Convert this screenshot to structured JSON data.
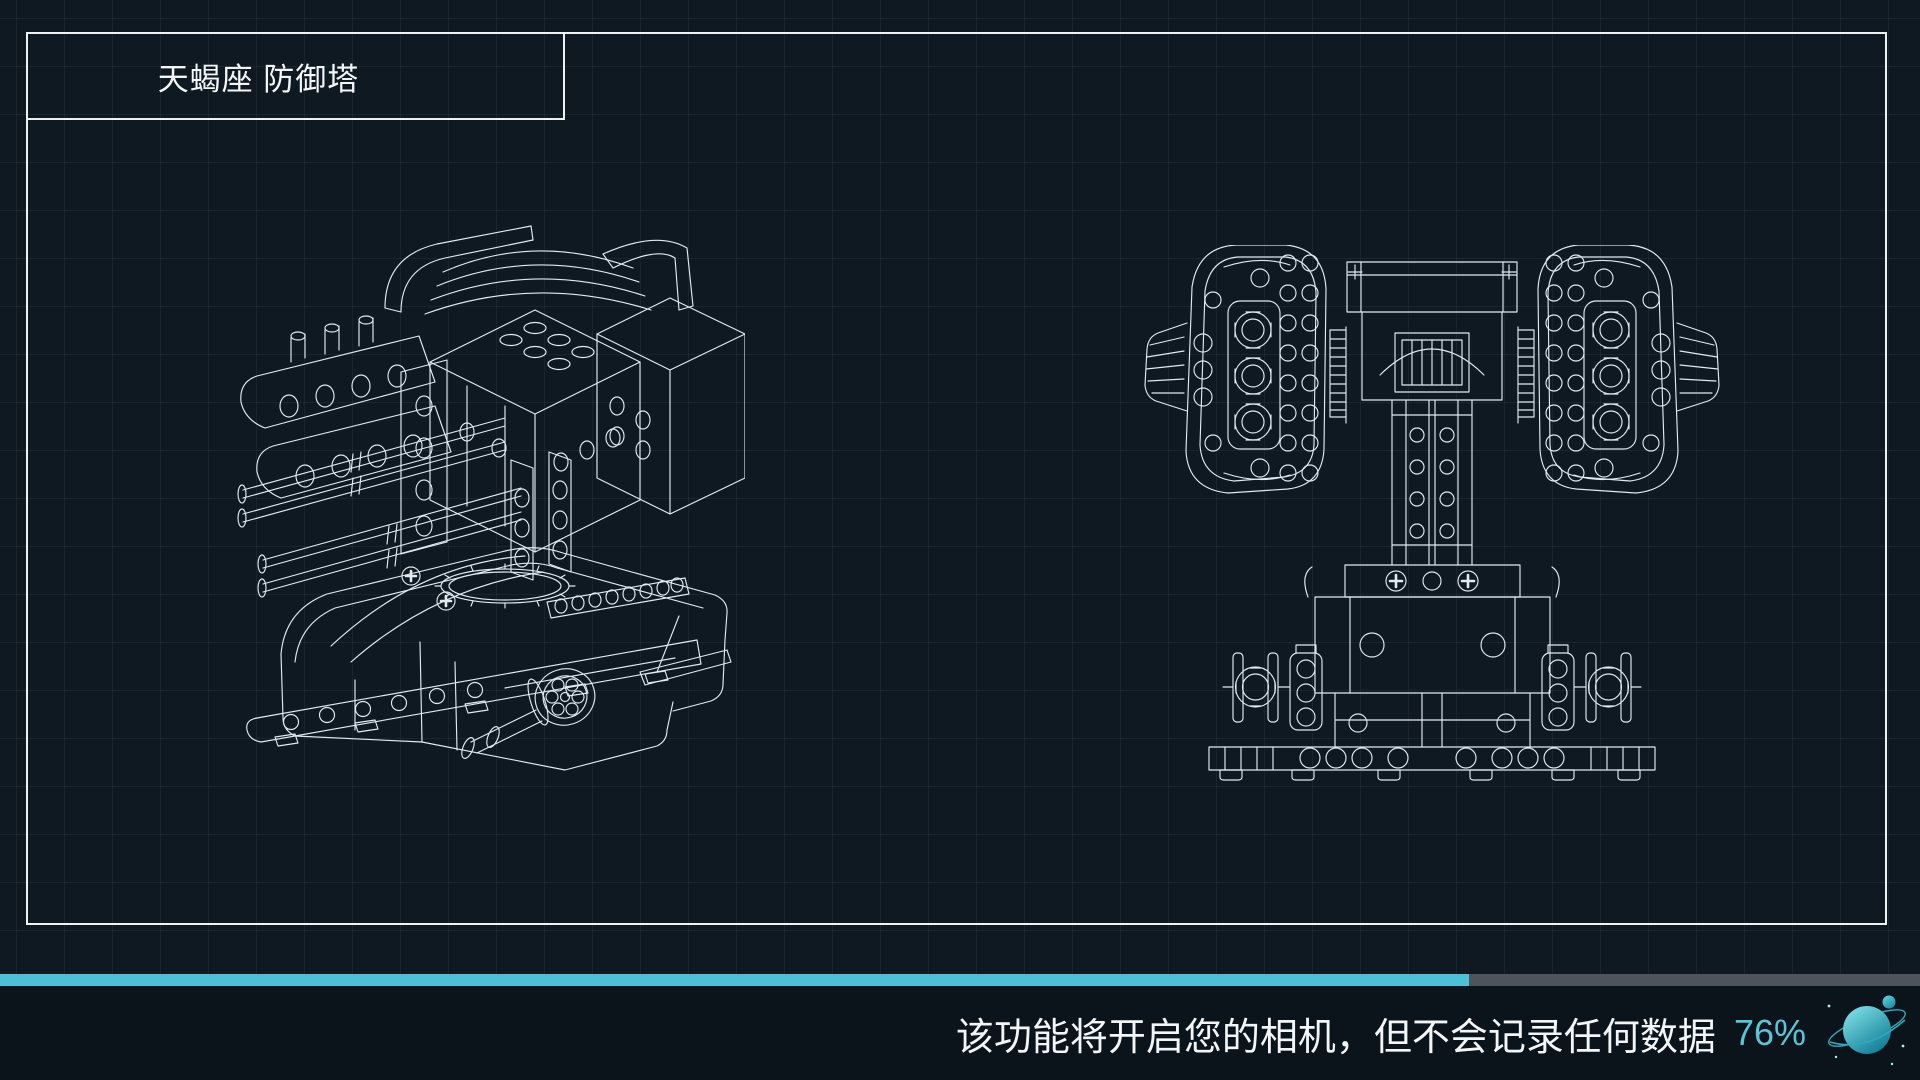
{
  "window": {
    "background": "#0e1922",
    "footer_background": "#0b141b",
    "frame_color": "#edf2f5"
  },
  "title_panel": {
    "label": "天蝎座 防御塔"
  },
  "views": {
    "subject": "defense-tower-wireframe",
    "left": "isometric-view",
    "right": "front-view"
  },
  "progress": {
    "percent_label": "76%",
    "bar_fill_percent": 76.5,
    "fill_color": "#4bc0d6",
    "track_color": "#4e545b",
    "percent_color": "#58c5d9"
  },
  "footer": {
    "message": "该功能将开启您的相机，但不会记录任何数据",
    "icon": "planet-icon"
  }
}
